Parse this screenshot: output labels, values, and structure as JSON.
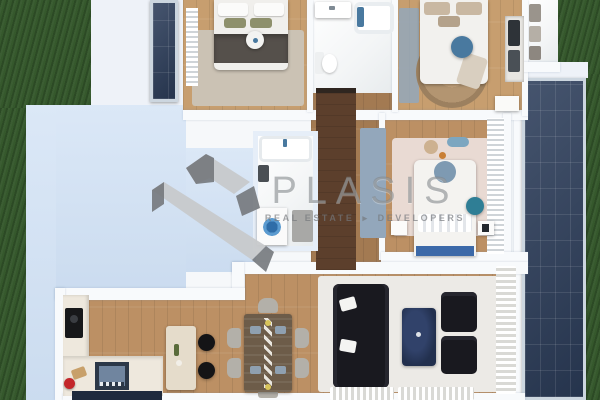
{
  "watermark": {
    "brand": "PLASIS",
    "tagline_left": "REAL ESTATE",
    "separator": "▸",
    "tagline_right": "DEVELOPERS"
  },
  "colors": {
    "grass": "#35582c",
    "terrace": "#cfe0f4",
    "roof": "#eef2f8",
    "wall": "#f8fafc",
    "wood": "#bc9064",
    "wood-light": "#c79e6f",
    "wood-mid": "#a37a52",
    "wood-dark": "#5c3f2c",
    "tile": "#f3f5f6",
    "panel": "#2c3d5a",
    "panel-frame": "#ccd6df",
    "rug-white": "#eceae6",
    "rug-beige": "#cbc2b4",
    "rug-pink": "#e9dad3",
    "jute": "#b39571",
    "sofa-black": "#19191f",
    "table-navy": "#22304e",
    "runner-blue": "#93a7bb",
    "accent-blue": "#49799f",
    "teal": "#2f7e95",
    "washer-blue": "#3f7fb5",
    "olive": "#8e906c",
    "chair-gray": "#b3b0a9",
    "counter": "#eee8dd",
    "island": "#e5dccb",
    "red": "#c3272b",
    "dark-console": "#1f2a3d",
    "throw-gray": "#55504b",
    "logo-light": "#c7c9cb",
    "logo-dark": "#74787c"
  }
}
